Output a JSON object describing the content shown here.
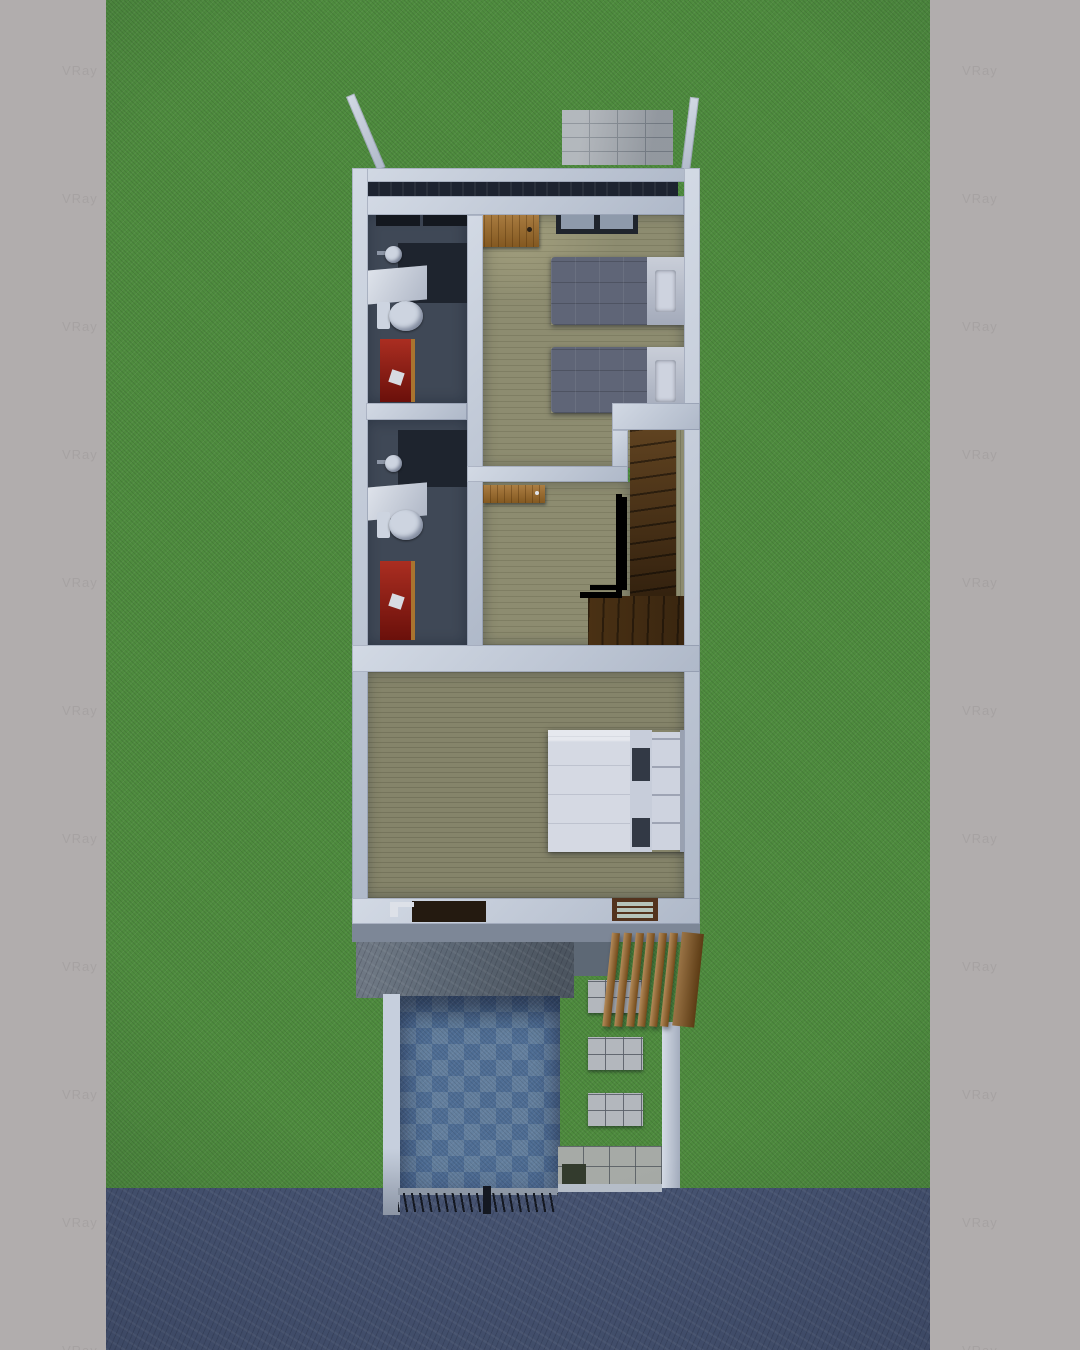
{
  "meta": {
    "title": "Top-down 3D architectural render — narrow two-storey house floor plan on a lawn",
    "render_engine_watermark": "VRay"
  },
  "watermark": {
    "text": "VRay",
    "rows": 11,
    "row_start": 63,
    "row_spacing": 128,
    "left_band_x": 62,
    "right_band_x": 32
  },
  "colors": {
    "frame": "#b1adad",
    "watermark": "#a5a1a1",
    "grass": "#4e8b3e",
    "road": "#465371",
    "wall": "#c6cfdd",
    "void": "#1d2330",
    "floor": "#8d8c70",
    "floor_master": "#85846a",
    "bath_floor": "#3f4856",
    "bath_dark": "#1e242e",
    "fixture": "#cdd4e0",
    "red": "#8e150e",
    "red_wood": "#a9742f",
    "door_wood": "#a06c28",
    "win_frame": "#1f242c",
    "pane": "#8e9aab",
    "blanket": "#5f6577",
    "linen": "#bcc2cf",
    "pillow": "#ced3df",
    "duvet": "#d5d9e3",
    "duvet_mid": "#c7cdda",
    "slot": "#323945",
    "rail": "#2b303b",
    "slab": "#5d6875",
    "slab_band": "#7d8797",
    "tile_a": "#4f6e95",
    "tile_b": "#64809f",
    "pergola": "#9a6322",
    "beam": "#84551d",
    "stone": "#b3b7bd",
    "walkway": "#a6aaa6",
    "mat": "#333b2d",
    "curb": "#b6bec9",
    "gate_rail": "#8d97a5",
    "gate_dark": "#141821",
    "brick": "#a7acb2",
    "brick_line": "#7f868e"
  },
  "scene": {
    "surroundings": [
      "lawn",
      "street",
      "render-frame-bands"
    ],
    "building": {
      "storey_shown": "upper floor (roof removed)",
      "rooms": [
        {
          "name": "front-terrace",
          "features": [
            "stone-accent-wall",
            "parapet-walls"
          ]
        },
        {
          "name": "bathroom-1",
          "fixtures": [
            "window",
            "washbasin",
            "vanity-counter",
            "toilet",
            "red-cabinet",
            "tissue-paper"
          ]
        },
        {
          "name": "bedroom-1",
          "furniture": [
            "single-bed",
            "single-bed"
          ],
          "features": [
            "wood-entry-door",
            "window"
          ]
        },
        {
          "name": "bathroom-2",
          "fixtures": [
            "washbasin",
            "vanity-counter",
            "toilet",
            "red-cabinet",
            "tissue-paper"
          ]
        },
        {
          "name": "hallway",
          "features": [
            "open-wood-door"
          ]
        },
        {
          "name": "staircase",
          "features": [
            "wood-treads",
            "dark-handrail",
            "lower-landing"
          ]
        },
        {
          "name": "master-bedroom",
          "furniture": [
            "double-bed"
          ],
          "features": [
            "dark-door-panel",
            "louver-window"
          ]
        }
      ]
    },
    "exterior": {
      "elements": [
        "concrete-slab",
        "pergola-slats",
        "carport-blue-checker-tiles",
        "carport-side-wall",
        "entry-pillar",
        "stepping-stones",
        "entry-walkway",
        "door-mat",
        "front-gate",
        "road"
      ],
      "pergola_slats": 6,
      "stepping_stones": 3
    }
  }
}
